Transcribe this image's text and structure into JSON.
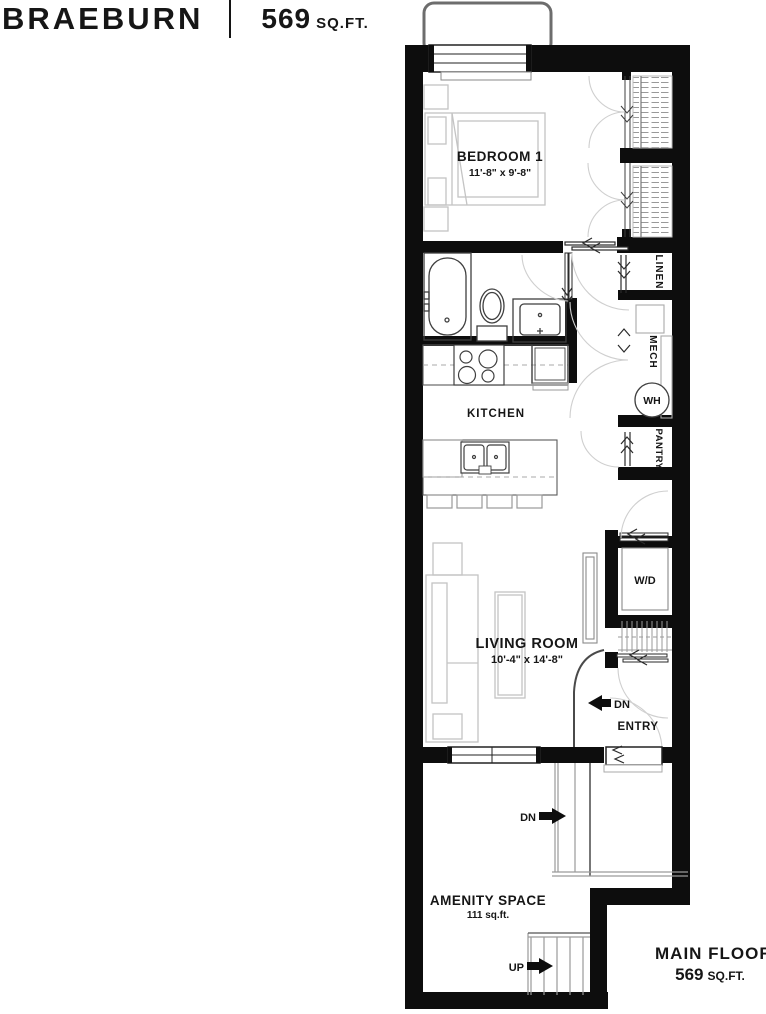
{
  "header": {
    "title": "BRAEBURN",
    "area_value": "569",
    "area_unit": "SQ.FT."
  },
  "footer": {
    "floor_label": "MAIN FLOOR",
    "area_value": "569",
    "area_unit": "SQ.FT."
  },
  "rooms": {
    "bedroom": {
      "name": "BEDROOM 1",
      "dims": "11'-8\" x 9'-8\""
    },
    "kitchen": {
      "name": "KITCHEN"
    },
    "living": {
      "name": "LIVING ROOM",
      "dims": "10'-4\" x 14'-8\""
    },
    "amenity": {
      "name": "AMENITY SPACE",
      "area": "111 sq.ft."
    },
    "entry": {
      "name": "ENTRY"
    },
    "linen": {
      "name": "LINEN"
    },
    "mech": {
      "name": "MECH"
    },
    "pantry": {
      "name": "PANTRY"
    },
    "water_heater": {
      "name": "WH"
    },
    "washer_dryer": {
      "name": "W/D"
    }
  },
  "annotations": {
    "down_entry": "DN",
    "down_amenity": "DN",
    "up_amenity": "UP"
  },
  "colors": {
    "wall": "#0d0d0d",
    "fixture_line": "#3f3f3f",
    "furniture_line": "#c4c4c4",
    "hatch_line": "#999999",
    "text": "#161616"
  }
}
